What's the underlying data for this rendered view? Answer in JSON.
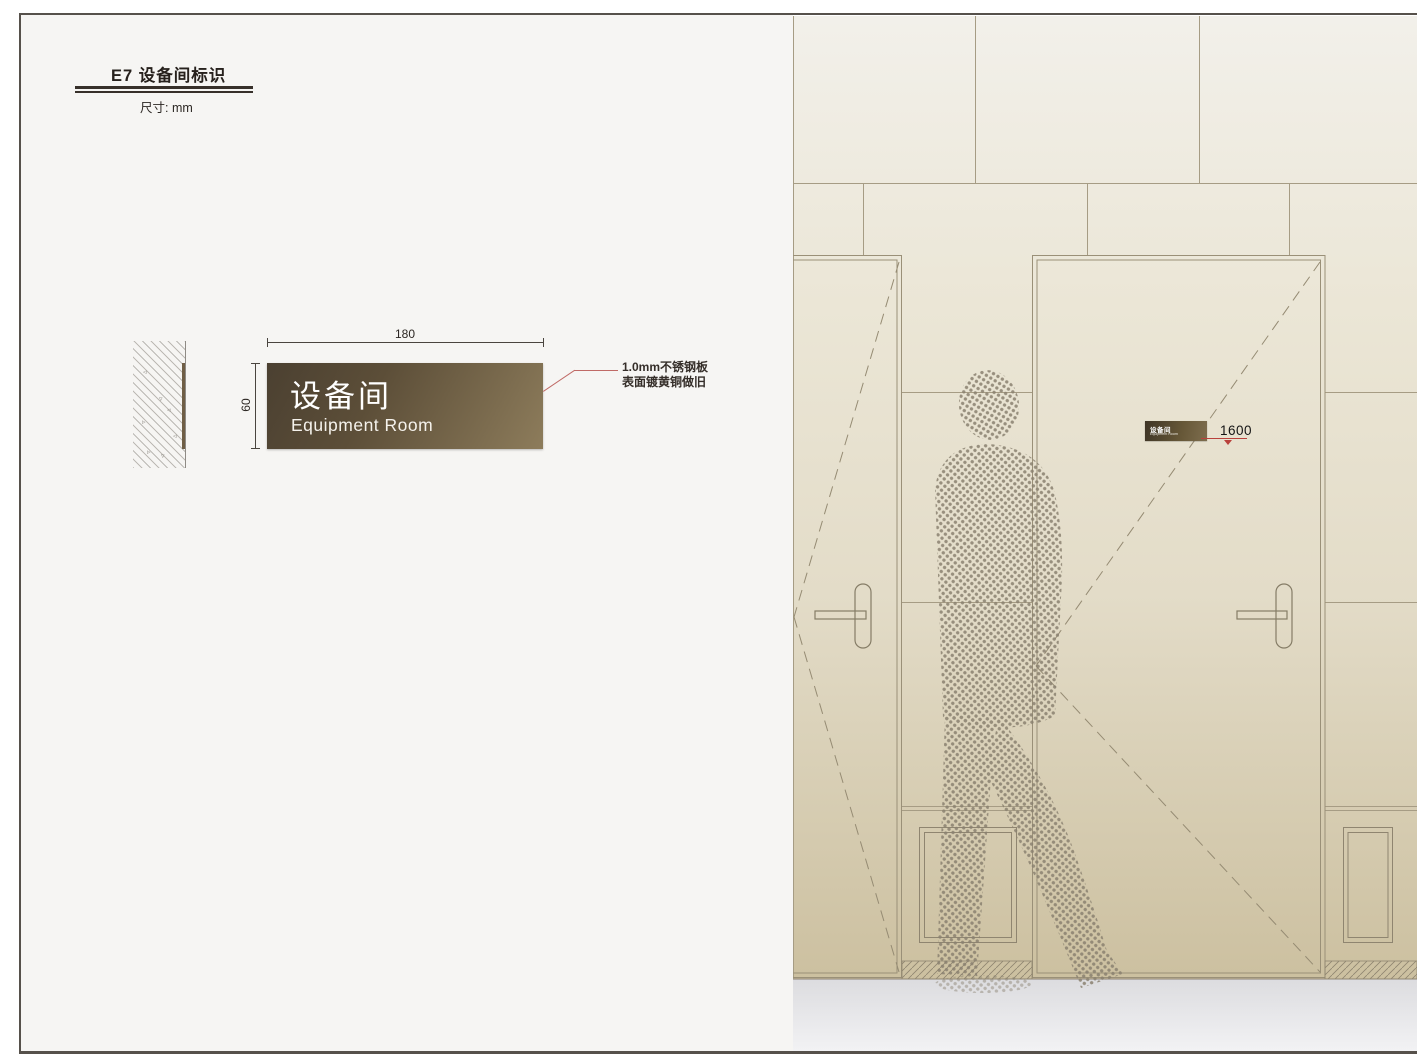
{
  "page": {
    "title": "E7 设备间标识",
    "unit_label": "尺寸: mm"
  },
  "spec": {
    "sign_zh": "设备间",
    "sign_en": "Equipment Room",
    "width_dim": "180",
    "height_dim": "60",
    "material_note_line1": "1.0mm不锈钢板",
    "material_note_line2": "表面镀黄铜做旧"
  },
  "elevation": {
    "door_sign_zh": "设备间",
    "door_sign_en": "Equipment Room",
    "mounting_height": "1600"
  },
  "colors": {
    "panel_dark": "#4b4031",
    "panel_light": "#8d7c5b",
    "leader_red": "#c06a66",
    "marker_red": "#b9413c",
    "wall_top": "#f2f0ea",
    "wall_mid": "#e3dcc8",
    "wall_bottom": "#ccc0a0",
    "line_color": "#9a9078"
  }
}
